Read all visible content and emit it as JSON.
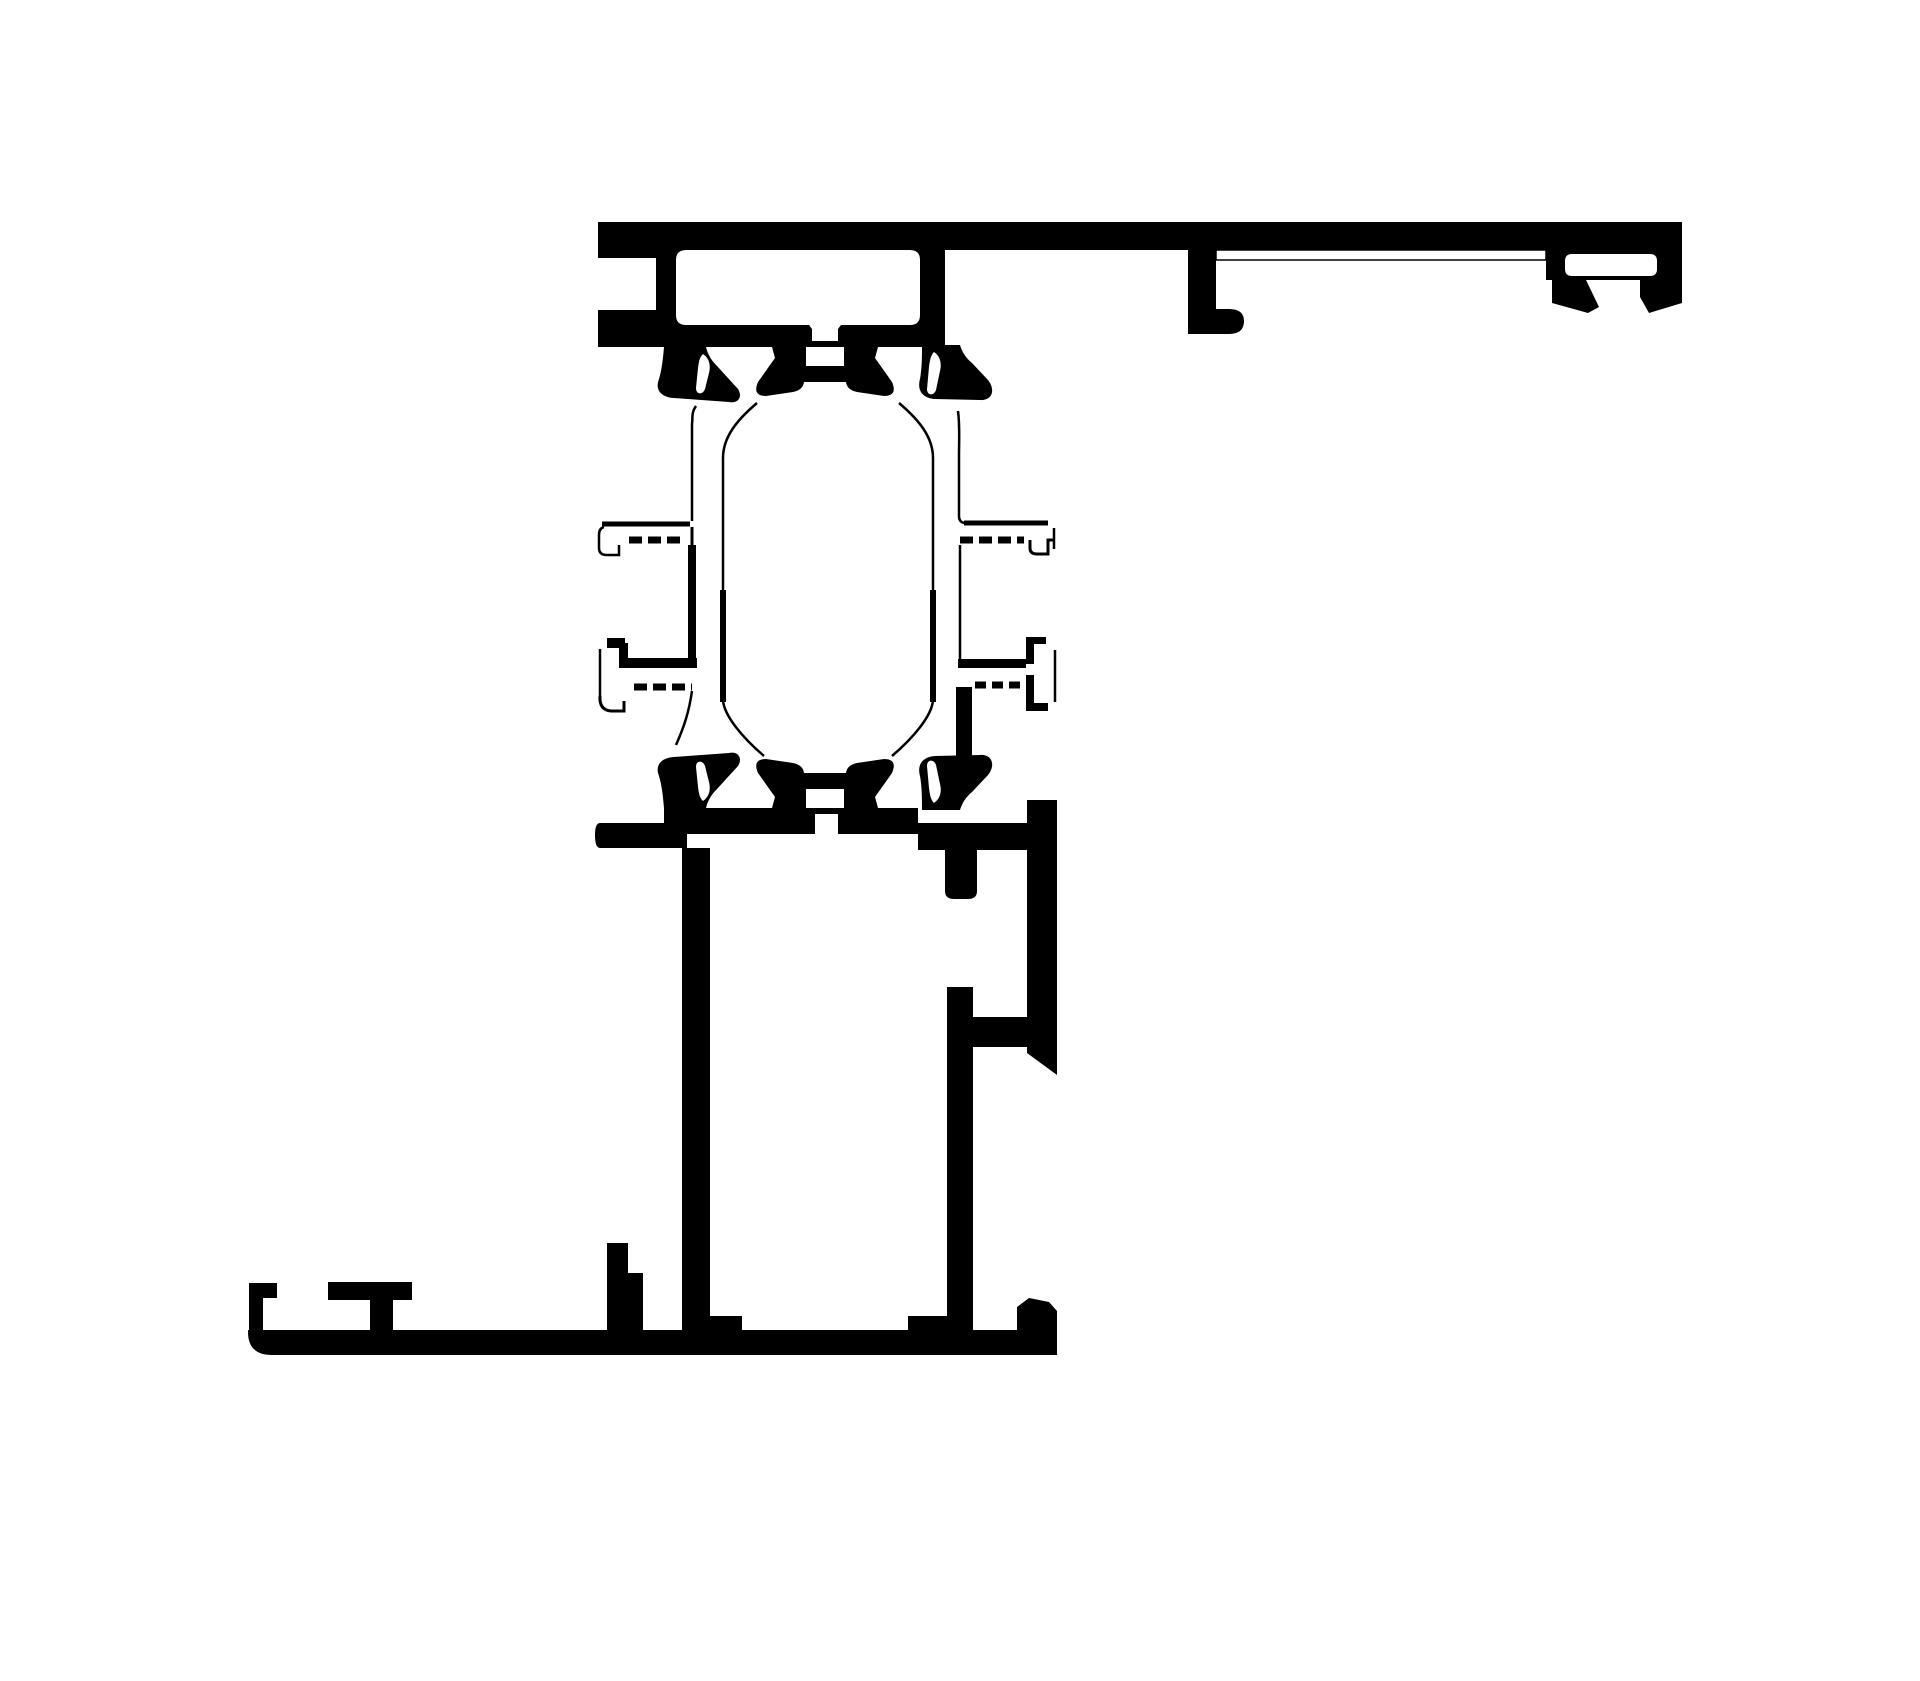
{
  "diagram": {
    "kind": "technical-cross-section",
    "background": "#ffffff",
    "ink": "#000000",
    "canvas": {
      "width": 1920,
      "height": 1681,
      "viewbox": "0 0 1920 1681"
    },
    "filled_parts": [
      {
        "name": "top-rail-and-chamber",
        "path": "M598,222 L1682,222 L1682,250 L945,250 L945,347 L598,347 L598,310 L656,310 L656,258 L598,258 Z M686,250 L910,250 Q920,250 920,260 L920,315 Q920,325 910,325 L841,325 L838,329 L838,341 L812,341 L812,329 L809,325 L686,325 Q676,325 676,315 L676,260 Q676,250 686,250 Z"
      },
      {
        "name": "accessory-block-right-end",
        "path": "M1546,250 L1682,250 L1682,280 L1546,280 Z M1572,254 Q1565,254 1565,261 L1565,269 Q1565,276 1572,276 L1650,276 Q1657,276 1657,269 L1657,261 Q1657,254 1650,254 Z"
      },
      {
        "name": "fin-left",
        "path": "M1552,280 L1586,280 L1599,307 L1588,313 L1552,303 Z"
      },
      {
        "name": "fin-right",
        "path": "M1640,280 L1682,280 L1682,303 L1649,313 L1640,297 Z"
      },
      {
        "name": "track-hook-leg",
        "path": "M1188,250 L1216,250 L1216,309 L1229,309 Q1244,309 1244,321 Q1244,334 1229,334 L1188,334 Z"
      },
      {
        "name": "gasket-top-left",
        "path": "M664,347 L706,347 C708,356 713,362 717,366 L738,389 C743,397 738,404 729,402 L674,398 C660,397 655,389 659,379 C662,369 663,358 664,347 Z M703,354 C709,358 711,365 709,373 L705,389 C703,395 696,395 696,388 L698,368 C699,360 700,357 703,354 Z"
      },
      {
        "name": "thermal-bridge-top",
        "path": "M772,347 L806,347 L806,366 L844,366 L844,347 L878,347 L875,358 L892,382 Q898,396 884,396 L857,392 Q847,390 846,382 L804,382 Q803,390 793,392 L766,396 Q752,396 758,382 L775,358 Z"
      },
      {
        "name": "gasket-top-right",
        "path": "M922,345 L960,345 C962,352 966,358 972,363 L988,380 C996,390 992,401 980,400 L935,399 C922,398 917,390 920,379 C922,368 922,356 922,345 Z M934,352 C940,356 942,363 940,371 L936,390 C934,396 927,396 927,389 L929,367 C930,359 931,355 934,352 Z"
      },
      {
        "name": "gasket-bottom-left",
        "path": "M664,808 L706,808 C708,799 713,793 717,789 L738,766 C743,758 738,751 729,753 L674,757 C660,758 655,766 659,776 C662,786 663,797 664,808 Z M703,801 C709,797 711,790 709,782 L705,766 C703,760 696,760 696,767 L698,787 C699,795 700,798 703,801 Z"
      },
      {
        "name": "thermal-bridge-bottom",
        "path": "M772,808 L806,808 L806,789 L844,789 L844,808 L878,808 L875,797 L892,773 Q898,759 884,759 L857,763 Q847,765 846,773 L804,773 Q803,765 793,763 L766,759 Q752,759 758,773 L775,797 Z"
      },
      {
        "name": "gasket-bottom-right",
        "path": "M922,810 L960,810 C962,803 966,797 972,792 L988,775 C996,765 992,754 980,755 L935,756 C922,757 917,765 920,776 C922,787 922,799 922,810 Z M934,803 C940,799 942,792 940,784 L936,765 C934,759 927,759 927,766 L929,788 C930,796 931,800 934,803 Z"
      },
      {
        "name": "gasket-stem-right",
        "path": "M956,687 L972,687 L972,758 L956,758 Z"
      },
      {
        "name": "sill-arm-left",
        "path": "M600,823 L687,823 L687,848 L600,848 Q595,848 595,835 Q595,823 600,823 Z"
      },
      {
        "name": "sill-top-wall-left",
        "path": "M664,808 L918,808 L918,834 L838,834 L838,814 L815,814 L815,834 L664,834 Z"
      },
      {
        "name": "sill-top-wall-right",
        "path": "M918,823 L1027,823 L1027,850 L918,850 Z"
      },
      {
        "name": "sill-left-wall",
        "path": "M682,848 L710,848 L710,1332 L682,1332 Z"
      },
      {
        "name": "sill-stub",
        "path": "M945,850 L977,850 L977,891 Q977,899 968,899 L954,899 Q945,899 945,891 Z"
      },
      {
        "name": "sill-right-bar",
        "path": "M947,987 L973,987 L973,1332 L947,1332 Z"
      },
      {
        "name": "sill-right-arm",
        "path": "M973,1017 L1027,1017 L1027,1047 L973,1047 Z"
      },
      {
        "name": "sill-outer-right-wall",
        "path": "M1027,800 L1057,800 L1057,1075 L1027,1053 Z"
      },
      {
        "name": "sill-base-plate",
        "path": "M248,1330 L1017,1330 L1017,1307 L1029,1298 L1049,1302 L1057,1311 L1057,1355 L272,1355 Q248,1355 248,1332 Z"
      },
      {
        "name": "base-riser-tab",
        "path": "M249,1283 L277,1283 L277,1298 L263,1298 L263,1332 L249,1332 Z"
      },
      {
        "name": "base-mid-tab",
        "path": "M328,1282 L412,1282 L412,1300 L393,1300 L393,1332 L370,1332 L370,1300 L328,1300 Z"
      },
      {
        "name": "base-up-tab",
        "path": "M607,1243 L628,1243 L628,1273 L643,1273 L643,1332 L607,1332 Z"
      },
      {
        "name": "base-step-left",
        "path": "M707,1316 L742,1316 L742,1332 L707,1332 Z"
      },
      {
        "name": "base-step-right",
        "path": "M908,1316 L948,1316 L948,1332 L908,1332 Z"
      },
      {
        "name": "interlock-left-lower-rail",
        "path": "M607,638 L625,638 L625,643 L628,643 L628,658 L697,658 L697,668 L619,668 L619,648 L607,648 Z"
      },
      {
        "name": "interlock-right-lower-rail",
        "path": "M958,659 L1026,659 L1026,668 L958,668 Z"
      },
      {
        "name": "interlock-right-upper-tab",
        "path": "M1026,637 L1046,637 L1046,644 L1034,644 L1034,664 L1026,664 Z"
      },
      {
        "name": "interlock-right-lower-hook",
        "path": "M1026,675 L1034,675 L1034,703 L1048,703 L1048,711 L1026,711 Z"
      }
    ],
    "white_parts": [
      {
        "name": "bottom-lip-outline",
        "path": "M1216,250 L1546,250 L1546,260 L1216,260 Z"
      }
    ],
    "stroked_parts": [
      {
        "name": "sash-line-left-outer",
        "path": "M696,406 C691,413 693,418 692,424 L692,521",
        "width": 2.5,
        "dash": "none"
      },
      {
        "name": "hook-top-left-bar",
        "path": "M602,524 L690,524",
        "width": 5,
        "dash": "none"
      },
      {
        "name": "hook-top-left-j",
        "path": "M604,527 C600,528 599,531 599,535 L599,548 Q599,555 607,555 L619,555 L619,545",
        "width": 2.5,
        "dash": "none"
      },
      {
        "name": "hook-top-left-dash",
        "path": "M629,540 L684,540",
        "width": 7,
        "dash": "13,6"
      },
      {
        "name": "sash-line-left-mid",
        "path": "M692,527 L692,547",
        "width": 3,
        "dash": "none"
      },
      {
        "name": "sash-line-left-mid-thick",
        "path": "M692,545 L692,664",
        "width": 8,
        "dash": "none"
      },
      {
        "name": "hook-bot-left-dash",
        "path": "M634,687 L692,687",
        "width": 7,
        "dash": "13,6"
      },
      {
        "name": "hook-bot-left-vert",
        "path": "M600,649 L600,700",
        "width": 2.5,
        "dash": "none"
      },
      {
        "name": "hook-bot-left-j",
        "path": "M600,696 Q599,710 611,711 L624,711 L624,701",
        "width": 3,
        "dash": "none"
      },
      {
        "name": "sash-curve-left-bottom",
        "path": "M692,691 C689,712 684,727 676,745",
        "width": 2.5,
        "dash": "none"
      },
      {
        "name": "glazing-line-left-top",
        "path": "M757,403 C737,420 723,437 723,458 L723,592",
        "width": 2.5,
        "dash": "none"
      },
      {
        "name": "glazing-line-left-mid",
        "path": "M723,590 L723,702",
        "width": 6,
        "dash": "none"
      },
      {
        "name": "glazing-line-left-bottom",
        "path": "M723,700 C724,716 743,738 764,756",
        "width": 2.5,
        "dash": "none"
      },
      {
        "name": "glazing-line-right-top",
        "path": "M899,403 C919,420 933,437 933,458 L933,592",
        "width": 2.5,
        "dash": "none"
      },
      {
        "name": "glazing-line-right-mid",
        "path": "M933,590 L933,702",
        "width": 6,
        "dash": "none"
      },
      {
        "name": "glazing-line-right-bottom",
        "path": "M933,700 C932,716 913,738 892,756",
        "width": 2.5,
        "dash": "none"
      },
      {
        "name": "sash-line-right-outer",
        "path": "M958,411 C960,426 959,441 959,456 L959,516 Q959,523 966,523",
        "width": 2.5,
        "dash": "none"
      },
      {
        "name": "hook-top-right-bar",
        "path": "M964,523 L1048,523",
        "width": 5,
        "dash": "none"
      },
      {
        "name": "hook-top-right-dash",
        "path": "M960,540 L1024,540",
        "width": 7,
        "dash": "13,6"
      },
      {
        "name": "hook-top-right-j",
        "path": "M1030,540 L1030,548 Q1030,554 1037,554 L1048,554 L1048,540 L1054,540",
        "width": 3,
        "dash": "none"
      },
      {
        "name": "hook-top-right-vert",
        "path": "M1054,528 L1054,549",
        "width": 2.5,
        "dash": "none"
      },
      {
        "name": "sash-line-right-mid",
        "path": "M960,545 L960,659",
        "width": 2.5,
        "dash": "none"
      },
      {
        "name": "hook-bot-right-dash",
        "path": "M975,685 L1022,685",
        "width": 7,
        "dash": "11,6"
      },
      {
        "name": "sash-line-right-lower",
        "path": "M1055,650 L1055,702",
        "width": 2.5,
        "dash": "none"
      }
    ]
  }
}
